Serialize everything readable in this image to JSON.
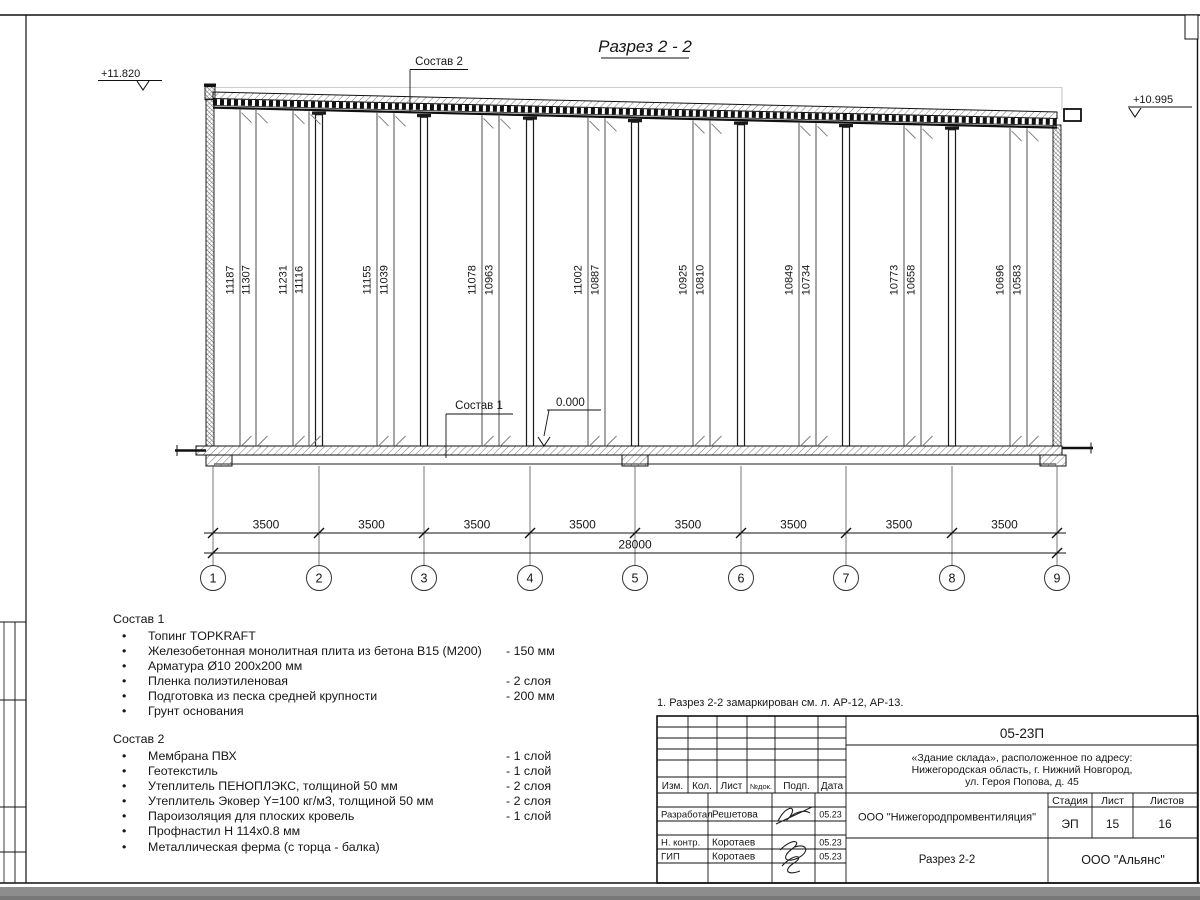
{
  "sheet": {
    "title": "Разрез 2 - 2",
    "note": "1. Разрез 2-2 замаркирован см. л. АР-12, АР-13."
  },
  "ui": {
    "bullet": "•"
  },
  "drawing": {
    "elev_left": "+11.820",
    "elev_right": "+10.995",
    "sostav2_label": "Состав 2",
    "sostav1_label": "Состав 1",
    "zero_level": "0.000",
    "rod_dims": [
      "11187",
      "11307",
      "11231",
      "11116",
      "11155",
      "11039",
      "11078",
      "10963",
      "11002",
      "10887",
      "10925",
      "10810",
      "10849",
      "10734",
      "10773",
      "10658",
      "10696",
      "10583"
    ],
    "bay_dims": [
      "3500",
      "3500",
      "3500",
      "3500",
      "3500",
      "3500",
      "3500",
      "3500"
    ],
    "total_dim": "28000",
    "grid_labels": [
      "1",
      "2",
      "3",
      "4",
      "5",
      "6",
      "7",
      "8",
      "9"
    ]
  },
  "sostav1": {
    "title": "Состав 1",
    "items": [
      {
        "text": "Топинг TOPKRAFT",
        "value": ""
      },
      {
        "text": "Железобетонная монолитная плита из бетона В15 (М200)",
        "value": "-  150 мм"
      },
      {
        "text": "Арматура Ø10 200х200 мм",
        "value": ""
      },
      {
        "text": "Пленка полиэтиленовая",
        "value": "-  2 слоя"
      },
      {
        "text": "Подготовка из песка средней крупности",
        "value": "- 200 мм"
      },
      {
        "text": "Грунт основания",
        "value": ""
      }
    ]
  },
  "sostav2": {
    "title": "Состав 2",
    "items": [
      {
        "text": "Мембрана ПВХ",
        "value": "- 1 слой"
      },
      {
        "text": "Геотекстиль",
        "value": "- 1 слой"
      },
      {
        "text": "Утеплитель ПЕНОПЛЭКС, толщиной 50 мм",
        "value": "- 2 слоя"
      },
      {
        "text": "Утеплитель Эковер Y=100 кг/м3, толщиной 50 мм",
        "value": "- 2 слоя"
      },
      {
        "text": "Пароизоляция для плоских кровель",
        "value": "- 1 слой"
      },
      {
        "text": "Профнастил Н 114х0.8 мм",
        "value": ""
      },
      {
        "text": "Металлическая ферма (с торца - балка)",
        "value": ""
      }
    ]
  },
  "titleblock": {
    "code": "05-23П",
    "object_lines": [
      "«Здание склада», расположенное по адресу:",
      "Нижегородская область, г. Нижний Новгород,",
      "ул. Героя Попова, д. 45"
    ],
    "cols": {
      "izm": "Изм.",
      "kol": "Кол.",
      "list": "Лист",
      "ndok": "№док.",
      "podp": "Подп.",
      "data": "Дата"
    },
    "rows": [
      {
        "role": "Разработал",
        "name": "Решетова",
        "date": "05.23"
      },
      {
        "role": "Н. контр.",
        "name": "Коротаев",
        "date": "05.23"
      },
      {
        "role": "ГИП",
        "name": "Коротаев",
        "date": "05.23"
      }
    ],
    "designer": "ООО \"Нижегородпромвентиляция\"",
    "stage_label": "Стадия",
    "sheet_label": "Лист",
    "sheets_label": "Листов",
    "stage": "ЭП",
    "sheet": "15",
    "sheets": "16",
    "view_name": "Разрез 2-2",
    "client": "ООО \"Альянс\""
  }
}
